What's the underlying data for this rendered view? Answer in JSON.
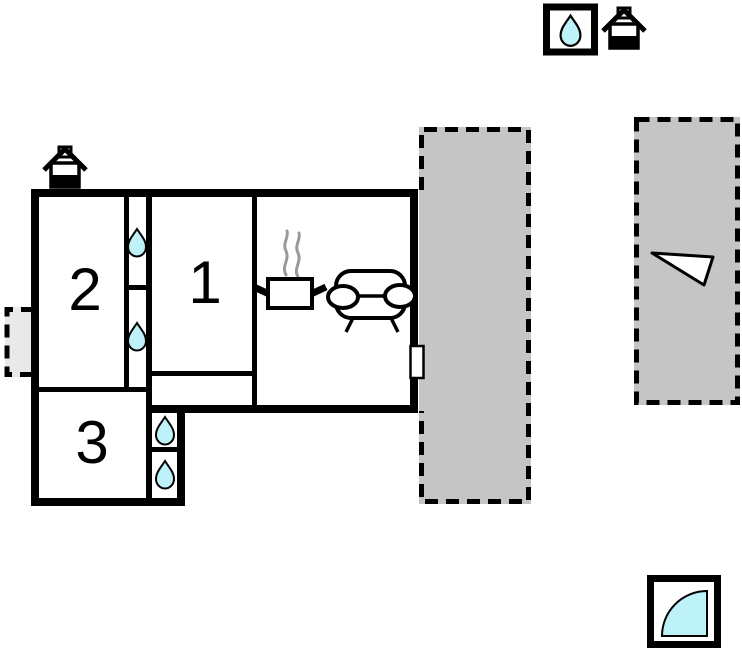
{
  "canvas": {
    "width": 742,
    "height": 652
  },
  "palette": {
    "wall": "#000000",
    "floor": "#ffffff",
    "terrace": "#c5c5c5",
    "annex": "#e9e9e9",
    "water": "#bdf2f9",
    "steam": "#9a9a9a"
  },
  "rooms": [
    {
      "label": "1"
    },
    {
      "label": "2"
    },
    {
      "label": "3"
    }
  ],
  "features": {
    "water_drop_count_in_plan": 4,
    "terrace_count": 2,
    "house_icon_count": 2,
    "legend_icons": [
      "water-drop-icon",
      "house-icon",
      "door-swing-icon"
    ],
    "furniture_icons": [
      "stove-pot-icon",
      "sofa-icon"
    ],
    "openings": [
      "entrance-door-icon",
      "window-triangle-icon"
    ]
  }
}
